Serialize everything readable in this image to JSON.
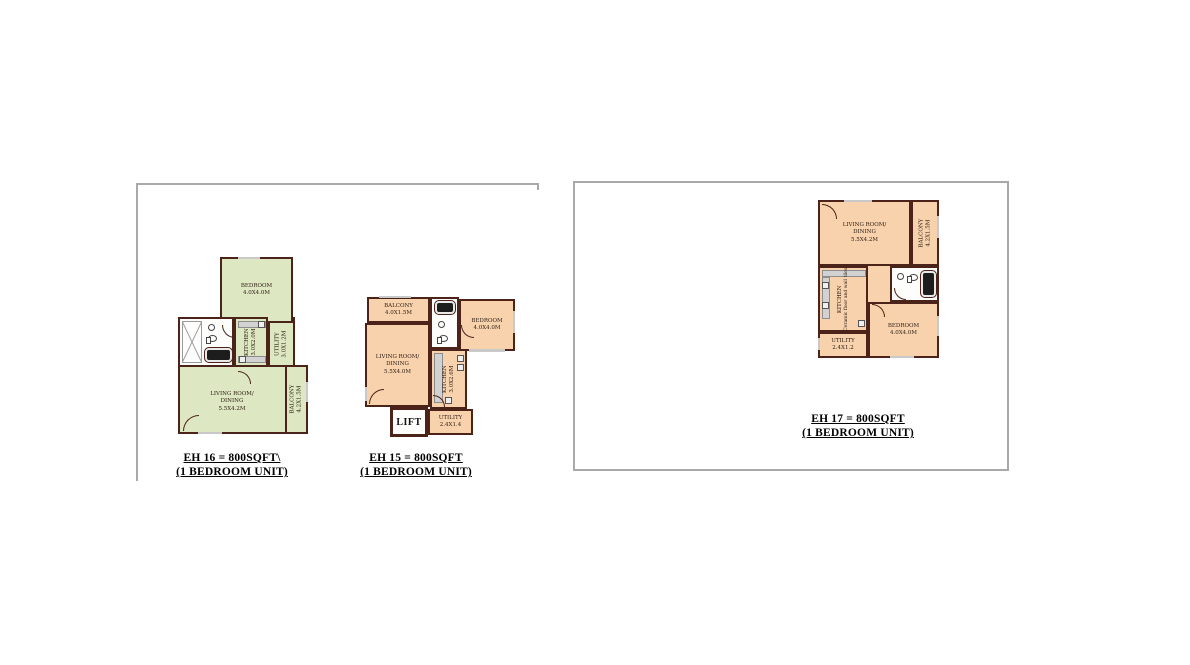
{
  "colors": {
    "wall": "#4b2318",
    "plan_green": "#dde7c2",
    "plan_peach": "#f8d2ad",
    "panel_border": "#a9a9a9",
    "counter_gray": "#d2d2d2",
    "ink": "#2b1c10"
  },
  "plans": {
    "eh16": {
      "caption": {
        "line1": "EH 16 = 800SQFT\\",
        "line2": "(1 BEDROOM UNIT)"
      },
      "rooms": {
        "bedroom": {
          "name": "BEDROOM",
          "dims": "4.0X4.0M"
        },
        "kitchen": {
          "name": "KITCHEN",
          "dims": "3.0X2.0M"
        },
        "utility": {
          "name": "UTILITY",
          "dims": "3.0X1.2M"
        },
        "living": {
          "line1": "LIVING ROOM/",
          "line2": "DINING",
          "dims": "5.5X4.2M"
        },
        "balcony": {
          "name": "BALCONY",
          "dims": "4.2X1.5M"
        }
      }
    },
    "eh15": {
      "caption": {
        "line1": "EH 15 = 800SQFT",
        "line2": "(1 BEDROOM UNIT)"
      },
      "rooms": {
        "balcony": {
          "name": "BALCONY",
          "dims": "4.0X1.5M"
        },
        "bedroom": {
          "name": "BEDROOM",
          "dims": "4.0X4.0M"
        },
        "living": {
          "line1": "LIVING ROOM/",
          "line2": "DINING",
          "dims": "5.5X4.0M"
        },
        "kitchen": {
          "name": "KITCHEN",
          "dims": "3.0X2.6M"
        },
        "lift": {
          "name": "LIFT"
        },
        "utility": {
          "name": "UTILITY",
          "dims": "2.4X1.4"
        }
      }
    },
    "eh17": {
      "caption": {
        "line1": "EH 17 = 800SQFT",
        "line2": "(1 BEDROOM UNIT)"
      },
      "rooms": {
        "living": {
          "line1": "LIVING ROOM/",
          "line2": "DINING",
          "dims": "5.5X4.2M"
        },
        "balcony": {
          "name": "BALCONY",
          "dims": "4.2X1.5M"
        },
        "kitchen": {
          "name": "KITCHEN",
          "note": "Ceramic floor and wall tiles"
        },
        "utility": {
          "name": "UTILITY",
          "dims": "2.4X1.2"
        },
        "bedroom": {
          "name": "BEDROOM",
          "dims": "4.0X4.0M"
        }
      }
    }
  }
}
